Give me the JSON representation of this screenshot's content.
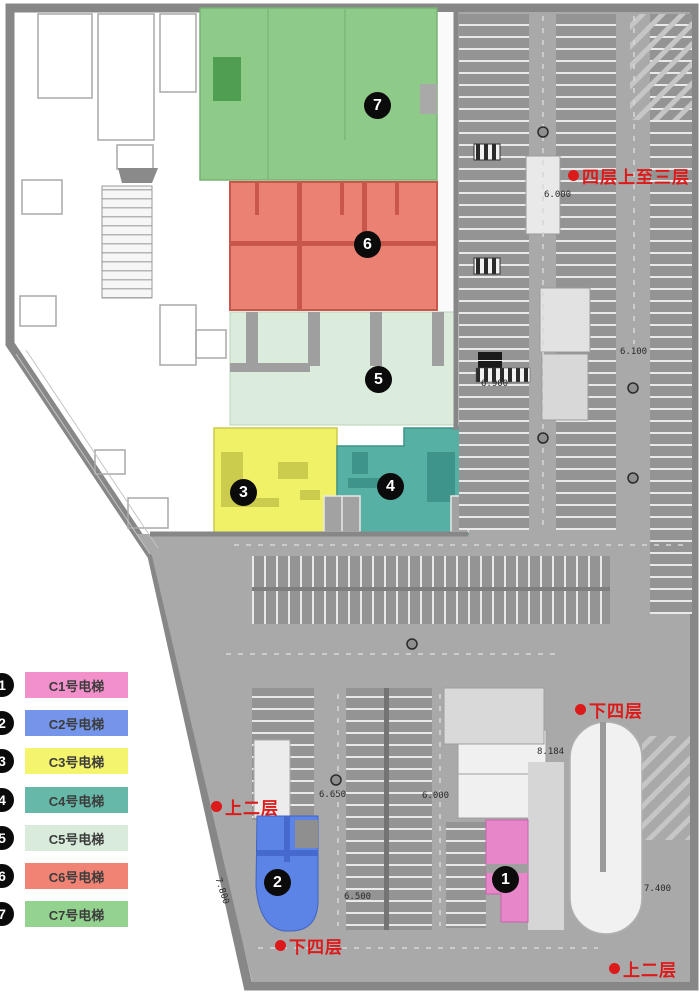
{
  "legend": {
    "items": [
      {
        "num": "1",
        "label": "C1号电梯",
        "color": "#f190ca"
      },
      {
        "num": "2",
        "label": "C2号电梯",
        "color": "#7495e9"
      },
      {
        "num": "3",
        "label": "C3号电梯",
        "color": "#f4f46d"
      },
      {
        "num": "4",
        "label": "C4号电梯",
        "color": "#66b9a9"
      },
      {
        "num": "5",
        "label": "C5号电梯",
        "color": "#d9ecdc"
      },
      {
        "num": "6",
        "label": "C6号电梯",
        "color": "#f08374"
      },
      {
        "num": "7",
        "label": "C7号电梯",
        "color": "#94d38f"
      }
    ]
  },
  "markers": [
    {
      "label": "1"
    },
    {
      "label": "2"
    },
    {
      "label": "3"
    },
    {
      "label": "4"
    },
    {
      "label": "5"
    },
    {
      "label": "6"
    },
    {
      "label": "7"
    }
  ],
  "annotations": [
    {
      "text": "四层上至三层"
    },
    {
      "text": "下四层"
    },
    {
      "text": "上二层"
    },
    {
      "text": "下四层"
    },
    {
      "text": "上二层"
    }
  ],
  "dimensions": [
    {
      "text": "6.000"
    },
    {
      "text": "6.100"
    },
    {
      "text": "6.900"
    },
    {
      "text": "8.184"
    },
    {
      "text": "7.400"
    },
    {
      "text": "6.650"
    },
    {
      "text": "6.000"
    },
    {
      "text": "7.800"
    },
    {
      "text": "6.500"
    }
  ],
  "colors": {
    "annotation_red": "#dd1a1a",
    "wall_gray": "#878787",
    "parking_gray": "#a9a9a9"
  }
}
